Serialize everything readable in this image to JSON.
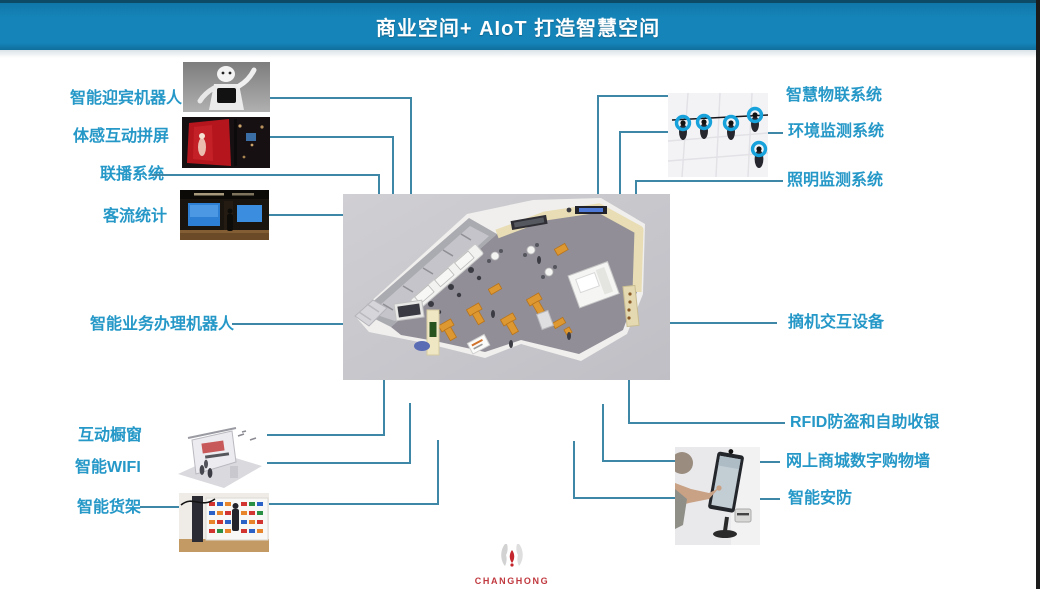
{
  "header": {
    "title": "商业空间+ AIoT  打造智慧空间"
  },
  "left_items": [
    {
      "label": "智能迎宾机器人"
    },
    {
      "label": "体感互动拼屏"
    },
    {
      "label": "联播系统"
    },
    {
      "label": "客流统计"
    },
    {
      "label": "智能业务办理机器人"
    },
    {
      "label": "互动橱窗"
    },
    {
      "label": "智能WIFI"
    },
    {
      "label": "智能货架"
    }
  ],
  "right_items": [
    {
      "label": "智慧物联系统"
    },
    {
      "label": "环境监测系统"
    },
    {
      "label": "照明监测系统"
    },
    {
      "label": "摘机交互设备"
    },
    {
      "label": "RFID防盗和自助收银"
    },
    {
      "label": "网上商城数字购物墙"
    },
    {
      "label": "智能安防"
    }
  ],
  "footer": {
    "brand": "CHANGHONG"
  },
  "colors": {
    "header_bg": "#1584b8",
    "label_text": "#2598c8",
    "connector": "#3f87a6",
    "logo_red": "#c4262d",
    "ring_blue": "#17a2dc"
  }
}
